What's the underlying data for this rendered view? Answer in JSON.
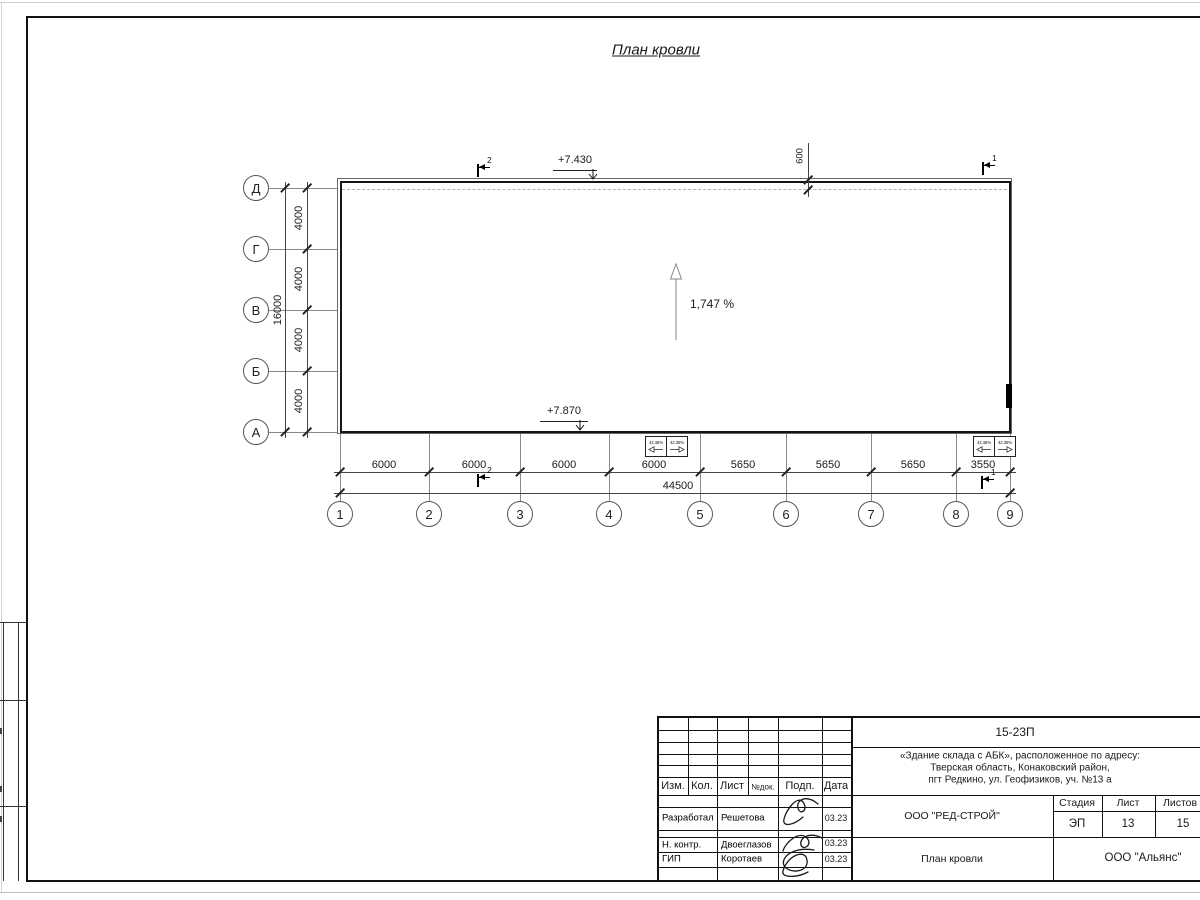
{
  "sheet": {
    "title": "План кровли"
  },
  "plan": {
    "elevation_top": "+7.430",
    "elevation_bottom": "+7.870",
    "slope": "1,747 %",
    "offset_600": "600",
    "section_left": "2",
    "section_right": "1",
    "drain_slope": "42.38%",
    "axes_rows": [
      "Д",
      "Г",
      "В",
      "Б",
      "А"
    ],
    "axes_cols": [
      "1",
      "2",
      "3",
      "4",
      "5",
      "6",
      "7",
      "8",
      "9"
    ],
    "dims_left_segments": [
      "4000",
      "4000",
      "4000",
      "4000"
    ],
    "dims_left_total": "16000",
    "dims_bottom_segments": [
      "6000",
      "6000",
      "6000",
      "6000",
      "5650",
      "5650",
      "5650",
      "3550"
    ],
    "dims_bottom_total": "44500"
  },
  "stamp": {
    "doc_number": "15-23П",
    "project_address_1": "«Здание склада с АБК», расположенное по адресу:",
    "project_address_2": "Тверская область, Конаковский район,",
    "project_address_3": "пгт Редкино, ул. Геофизиков, уч. №13 а",
    "col_izm": "Изм.",
    "col_kol": "Кол.",
    "col_list": "Лист",
    "col_ndok": "№док.",
    "col_podp": "Подп.",
    "col_data": "Дата",
    "row_developed_role": "Разработал",
    "row_developed_name": "Решетова",
    "row_developed_date": "03.23",
    "row_ncontr_role": "Н. контр.",
    "row_ncontr_name": "Двоеглазов",
    "row_ncontr_date": "03.23",
    "row_gip_role": "ГИП",
    "row_gip_name": "Коротаев",
    "row_gip_date": "03.23",
    "org": "ООО \"РЕД-СТРОЙ\"",
    "sheet_title": "План кровли",
    "contractor": "ООО \"Альянс\"",
    "stage_label": "Стадия",
    "list_label": "Лист",
    "listov_label": "Листов",
    "stage_value": "ЭП",
    "list_value": "13",
    "listov_value": "15"
  }
}
